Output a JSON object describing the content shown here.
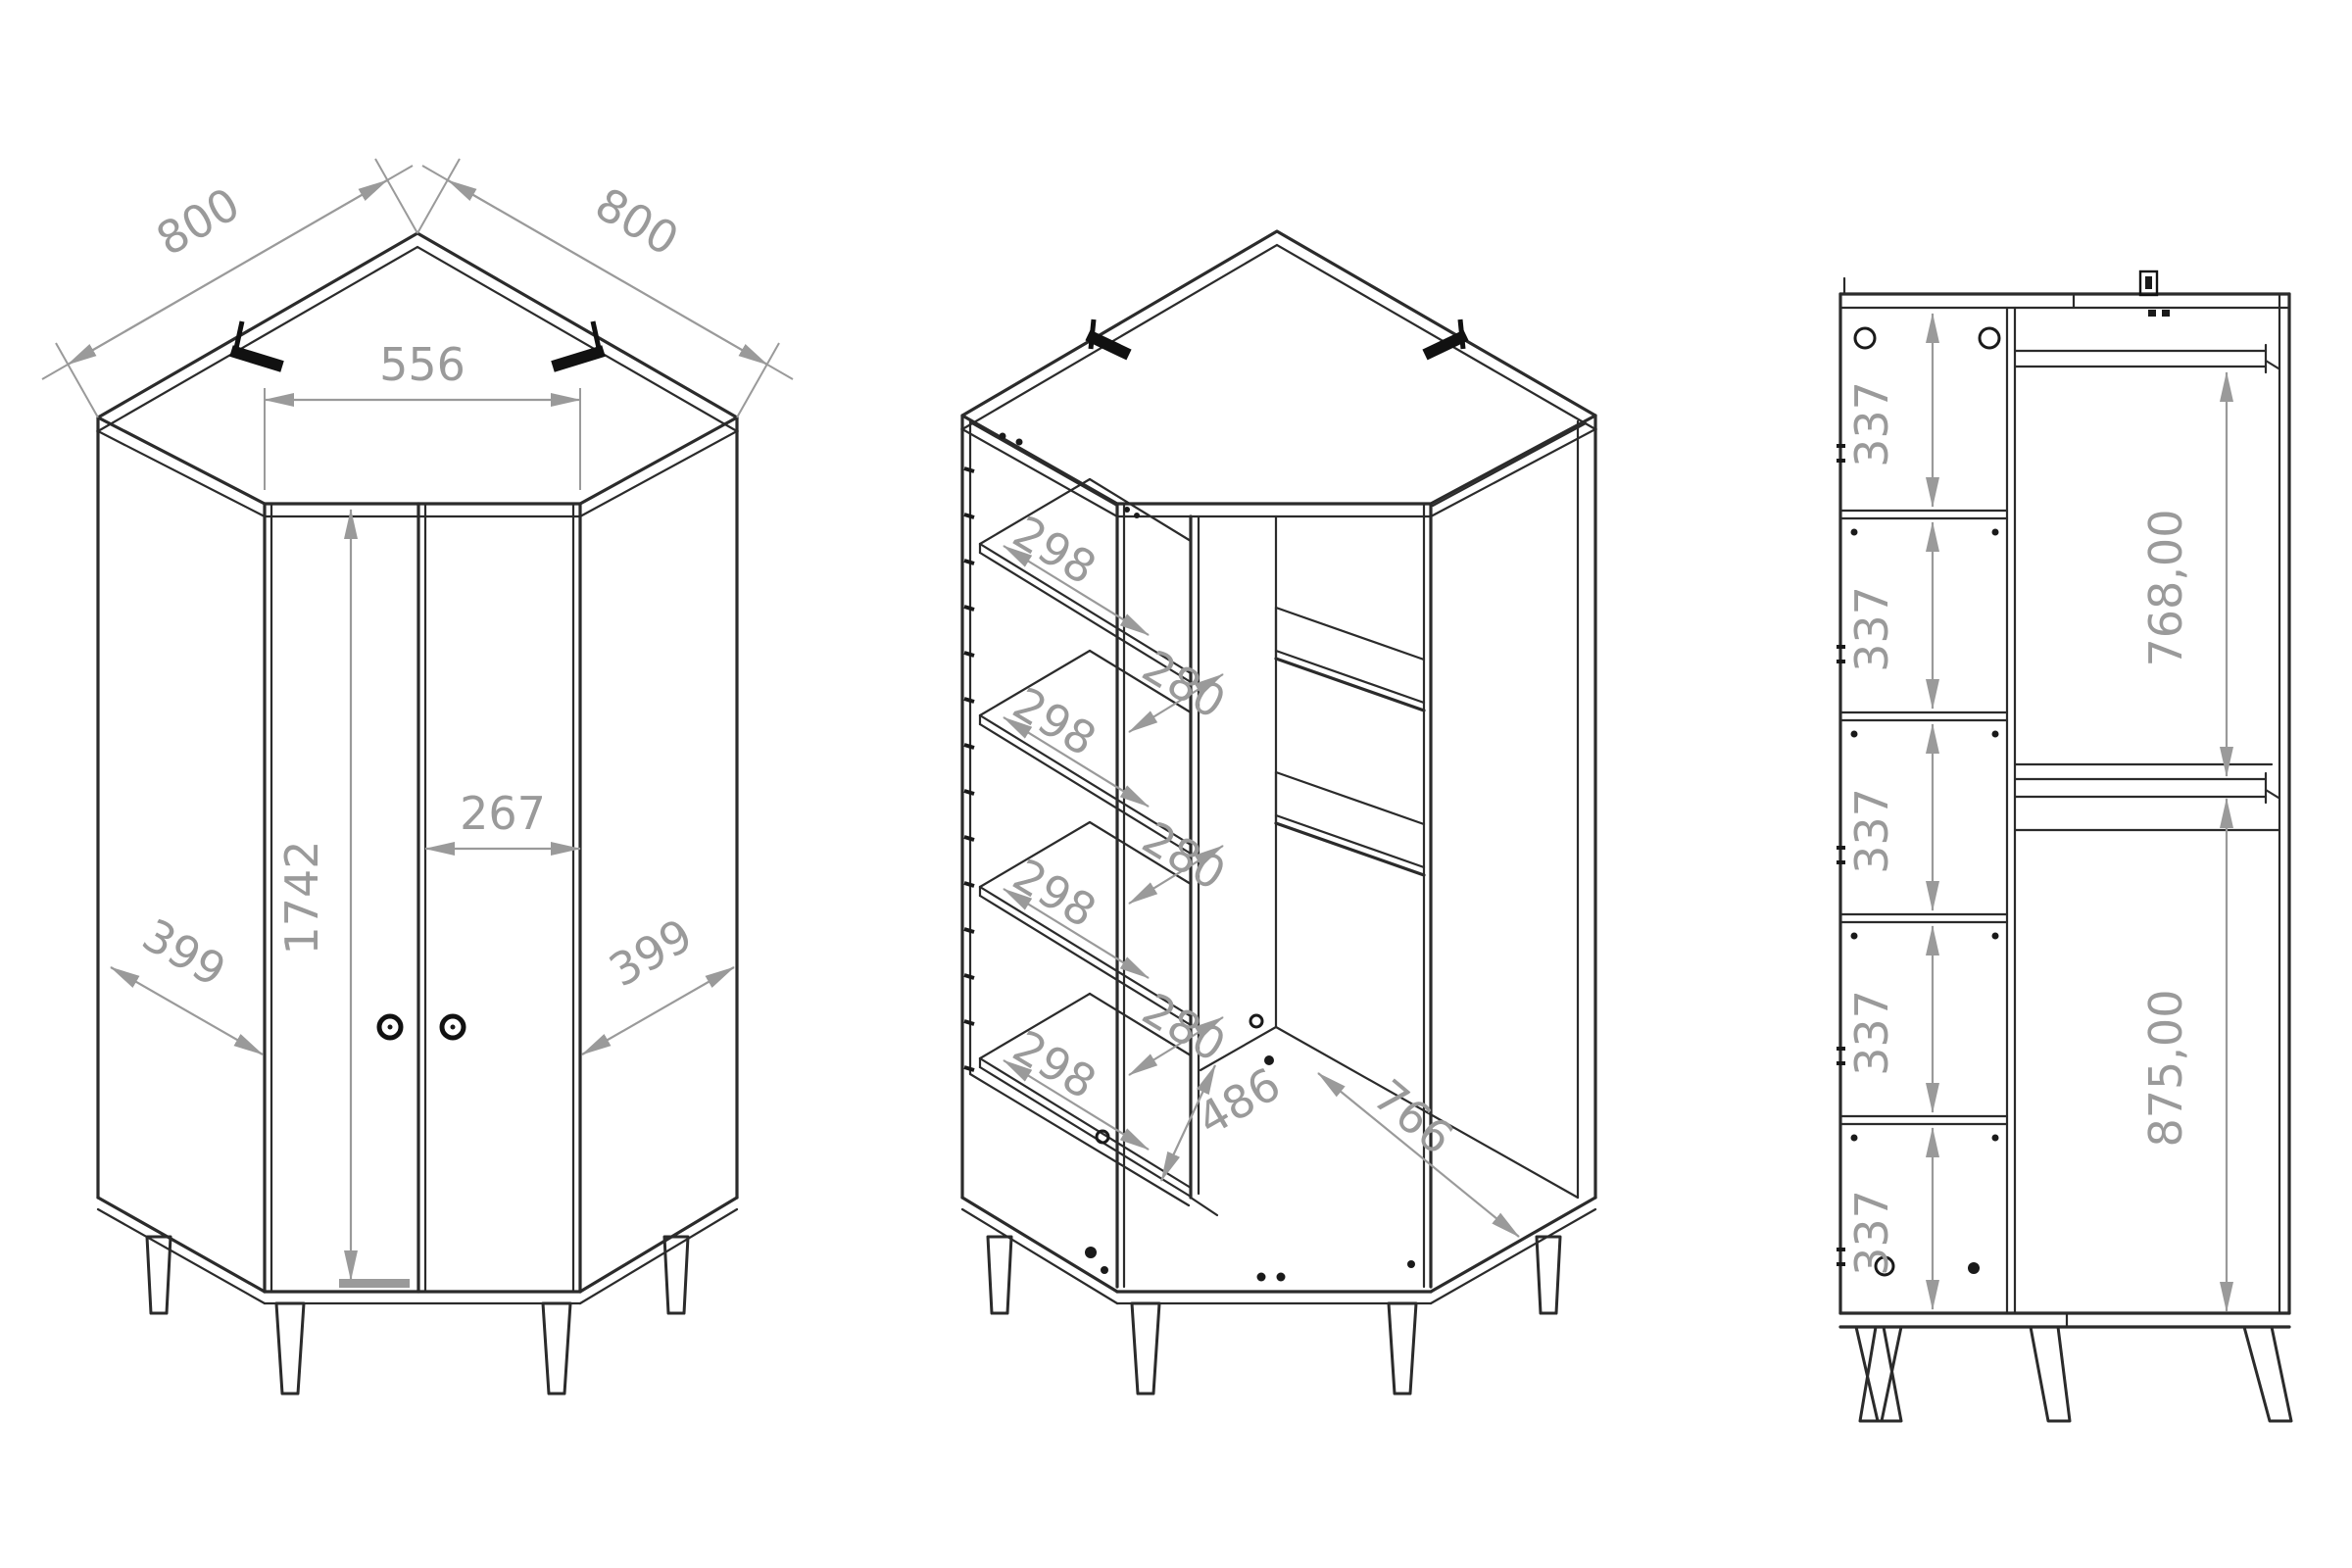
{
  "drawing": {
    "title": "corner-wardrobe-technical-drawing",
    "colors": {
      "line": "#2b2b2b",
      "dimension": "#9a9a9a",
      "background": "#ffffff"
    },
    "exterior": {
      "depth_left": "800",
      "depth_right": "800",
      "front_width": "556",
      "door_width": "267",
      "door_height": "1742",
      "side_left": "399",
      "side_right": "399"
    },
    "interior": {
      "shelf_depths": [
        "298",
        "298",
        "298",
        "298"
      ],
      "shelf_gaps": [
        "280",
        "280",
        "280"
      ],
      "inner_depth": "486",
      "inner_width": "766"
    },
    "section": {
      "compartment_heights": [
        "337",
        "337",
        "337",
        "337",
        "337"
      ],
      "upper_height": "768,00",
      "lower_height": "875,00"
    }
  }
}
